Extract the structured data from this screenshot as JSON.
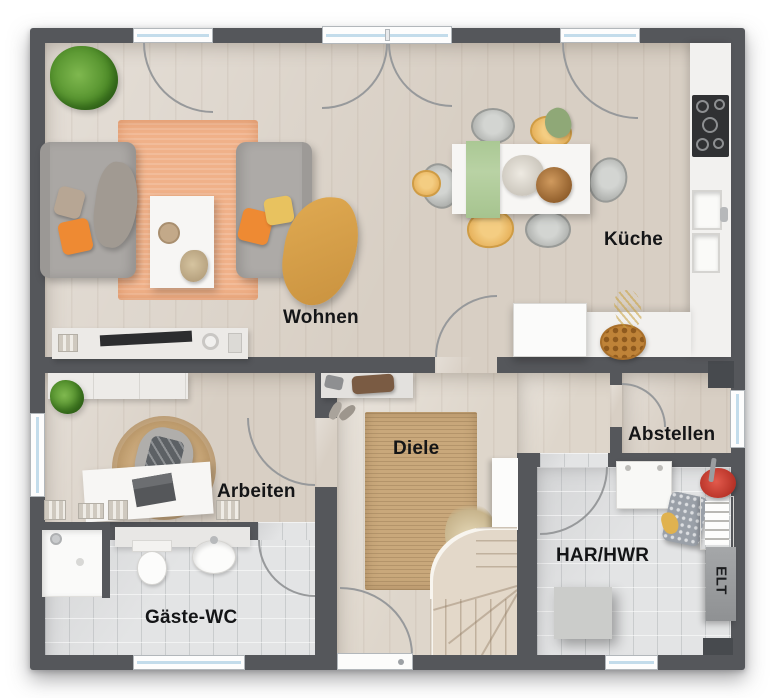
{
  "palette": {
    "wall": "#55575b",
    "floor_wood": "#d8cfc4",
    "floor_wood_light": "#ded6cb",
    "floor_tile": "#e3e4e5",
    "rug_orange": "#f0b189",
    "rug_jute": "#c9a87b",
    "counter": "#f2f1ef",
    "accent_orange": "#ee8a33",
    "accent_yellow": "#e2b45c",
    "accent_green": "#b4cd9f",
    "arc": "#97999b",
    "label": "#141517"
  },
  "rooms": {
    "wohnen": {
      "label": "Wohnen"
    },
    "kueche": {
      "label": "Küche"
    },
    "arbeiten": {
      "label": "Arbeiten"
    },
    "diele": {
      "label": "Diele"
    },
    "abstellen": {
      "label": "Abstellen"
    },
    "har_hwr": {
      "label": "HAR/HWR"
    },
    "gaeste_wc": {
      "label": "Gäste-WC"
    },
    "elt": {
      "label": "ELT"
    }
  }
}
